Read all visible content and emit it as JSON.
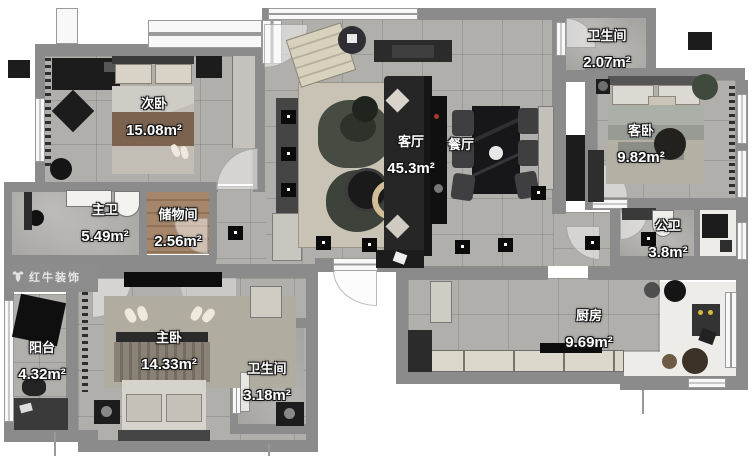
{
  "plan": {
    "watermark": {
      "brand": "红牛装饰"
    },
    "rooms": [
      {
        "key": "ciwo",
        "name": "次卧",
        "area": "15.08m²"
      },
      {
        "key": "zhuwei",
        "name": "主卫",
        "area": "5.49m²"
      },
      {
        "key": "chuwujian",
        "name": "储物间",
        "area": "2.56m²"
      },
      {
        "key": "keting",
        "name": "客厅",
        "area": "45.3m²"
      },
      {
        "key": "canting",
        "name": "餐厅",
        "area": ""
      },
      {
        "key": "weishengjian_top",
        "name": "卫生间",
        "area": "2.07m²"
      },
      {
        "key": "kewo",
        "name": "客卧",
        "area": "9.82m²"
      },
      {
        "key": "gongwei",
        "name": "公卫",
        "area": "3.8m²"
      },
      {
        "key": "chufang",
        "name": "厨房",
        "area": "9.69m²"
      },
      {
        "key": "zhuwo",
        "name": "主卧",
        "area": "14.33m²"
      },
      {
        "key": "weishengjian_bottom",
        "name": "卫生间",
        "area": "3.18m²"
      },
      {
        "key": "yangtai",
        "name": "阳台",
        "area": "4.32m²"
      }
    ],
    "colors": {
      "wall": "#8b8b8b",
      "floor_tile": "#b1afac",
      "floor_wood": "#9d7e61",
      "floor_white": "#edece8",
      "rug": "#c9c3b5",
      "furniture_dark": "#1c1c1c",
      "label_text": "#ffffff"
    }
  }
}
